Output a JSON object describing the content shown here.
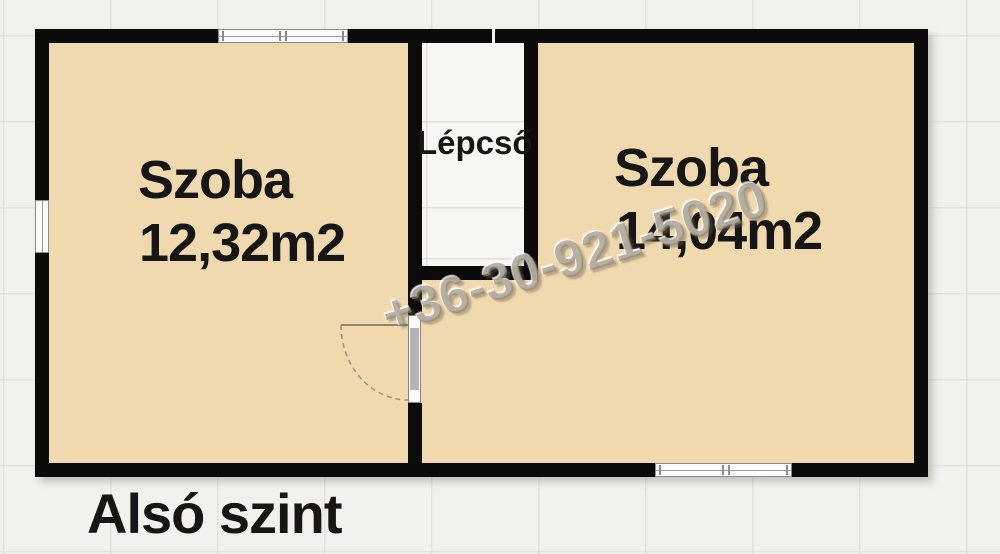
{
  "plan": {
    "level_label": "Alsó szint",
    "staircase_label": "Lépcső",
    "watermark_phone": "+36-30-921-5020",
    "rooms": {
      "left": {
        "name": "Szoba",
        "area": "12,32m2"
      },
      "right": {
        "name": "Szoba",
        "area": "14,04m2"
      }
    },
    "colors": {
      "wall": "#0b0b0b",
      "room_fill": "#f0d9ae",
      "background": "#f2f1ed",
      "staircase_fill": "#f7f6f3",
      "window_fill": "#fcfcfc",
      "watermark": "#8e8472",
      "label_text": "#161616"
    }
  }
}
